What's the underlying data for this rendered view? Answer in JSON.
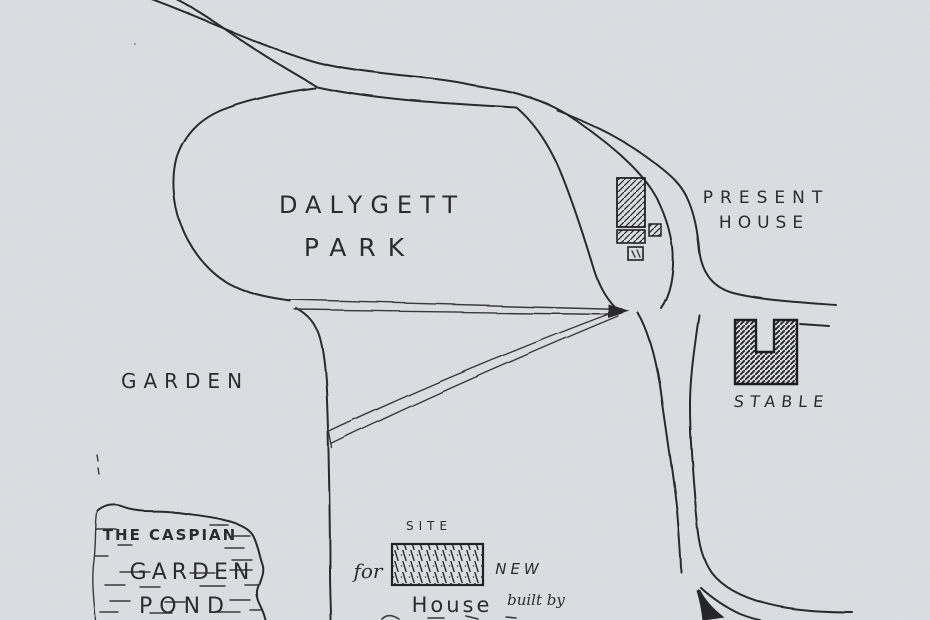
{
  "colors": {
    "paper": "#dcdde2",
    "ink": "#2c2b2f"
  },
  "labels": {
    "park": {
      "line1": "DALYGETT",
      "line2": "PARK"
    },
    "present_house": {
      "line1": "PRESENT",
      "line2": "HOUSE"
    },
    "garden": "GARDEN",
    "stable": "STABLE",
    "pond": {
      "line1": "THE CASPIAN",
      "line2": "GARDEN",
      "line3": "POND"
    },
    "site": {
      "word1": "SITE",
      "word2": "for",
      "word3": "NEW",
      "word4": "House",
      "word5": "built by"
    }
  },
  "features": [
    "main-road",
    "carriage-drive-loop",
    "present-house-building",
    "stable-building",
    "park-boundary",
    "garden-boundary",
    "straight-avenue",
    "diagonal-avenue",
    "south-road",
    "pond-outline",
    "site-for-new-house"
  ]
}
